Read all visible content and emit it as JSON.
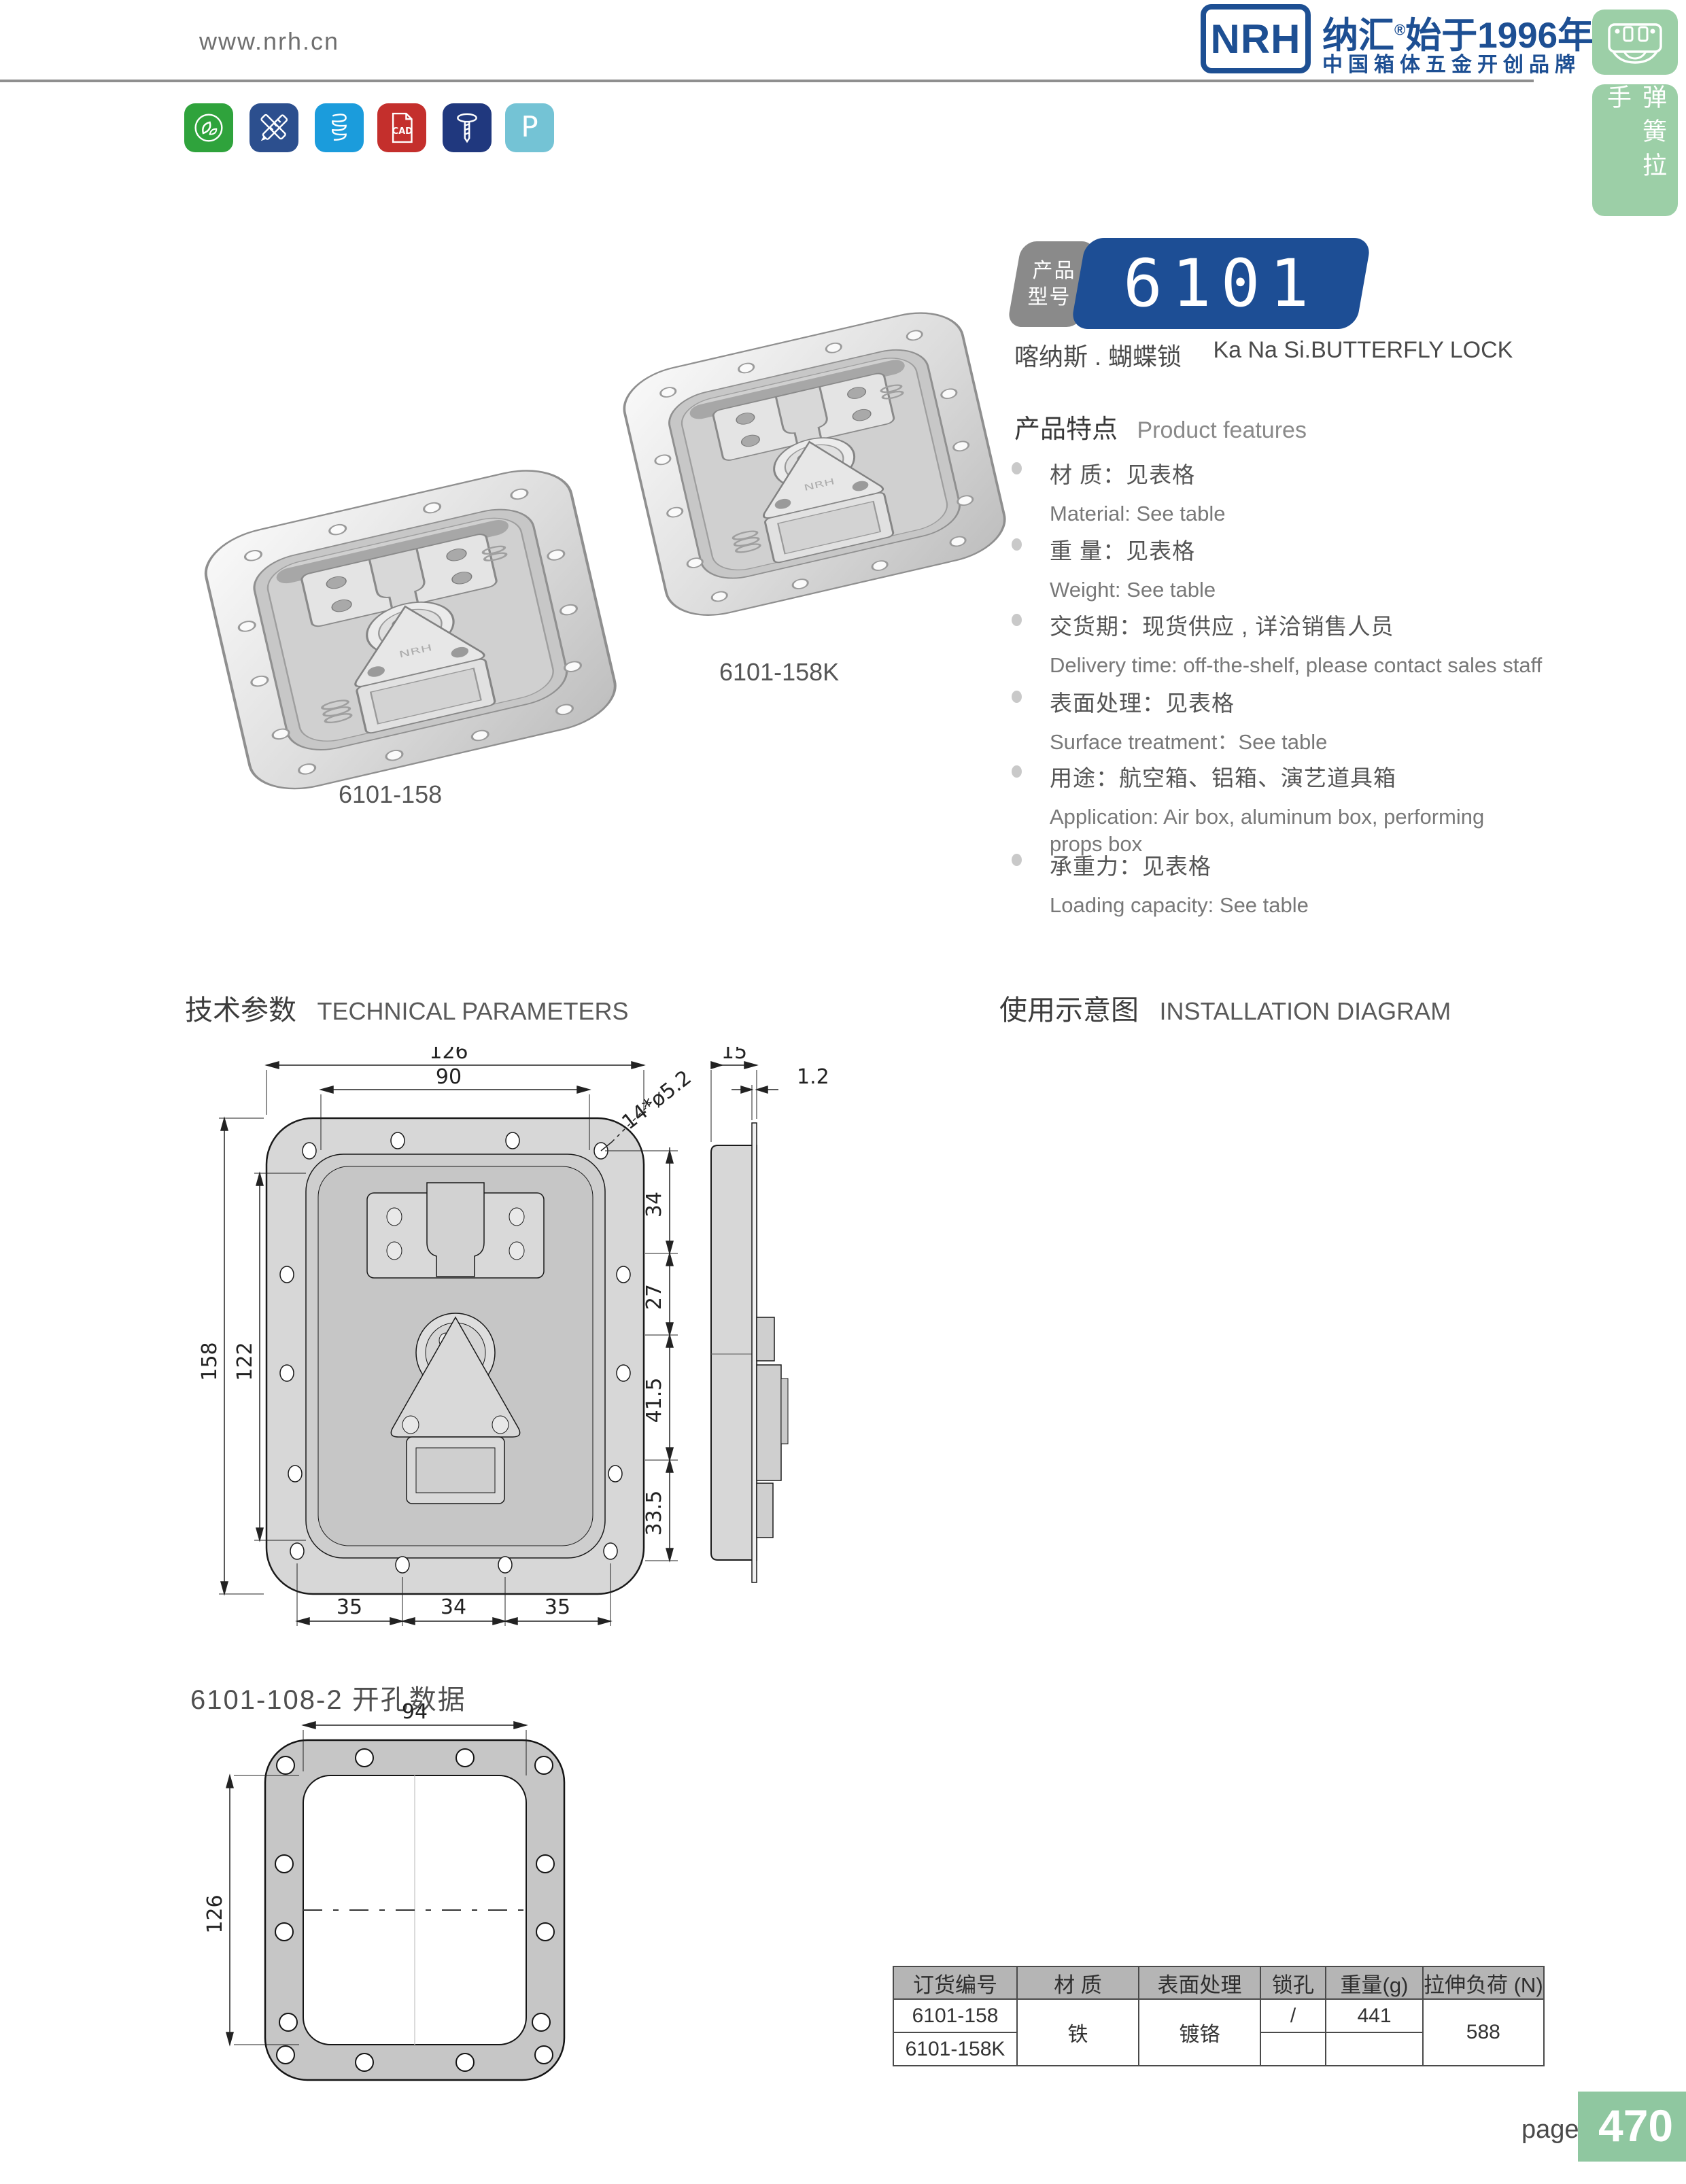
{
  "page": {
    "label": "page",
    "number": "470"
  },
  "header": {
    "website": "www.nrh.cn",
    "logo_abbr": "NRH",
    "brand_title": "纳汇",
    "brand_reg": "®",
    "brand_title_rest": "始于1996年",
    "brand_subtitle": "中国箱体五金开创品牌"
  },
  "sidebar": {
    "category": "弹簧拉手"
  },
  "toolbar_icons": [
    {
      "name": "eco-leaf",
      "bg": "#2fa33c"
    },
    {
      "name": "design-tools",
      "bg": "#2c4f8e"
    },
    {
      "name": "spring-coil",
      "bg": "#1b9cdc"
    },
    {
      "name": "cad-file",
      "bg": "#c42f2c",
      "label": "CAD"
    },
    {
      "name": "screw",
      "bg": "#20387e"
    },
    {
      "name": "letter-p",
      "bg": "#74c3d5",
      "label": "P"
    }
  ],
  "product": {
    "badge_top": "产品",
    "badge_bottom": "型号",
    "model": "6101",
    "name_cn": "喀纳斯 . 蝴蝶锁",
    "name_en": "Ka Na Si.BUTTERFLY LOCK",
    "photos": [
      {
        "label": "6101-158"
      },
      {
        "label": "6101-158K"
      }
    ]
  },
  "features": {
    "title_cn": "产品特点",
    "title_en": "Product features",
    "items": [
      {
        "cn": "材  质：见表格",
        "en": "Material: See table"
      },
      {
        "cn": "重  量：见表格",
        "en": "Weight: See table"
      },
      {
        "cn": "交货期：现货供应 , 详洽销售人员",
        "en": "Delivery time: off-the-shelf, please contact sales staff"
      },
      {
        "cn": "表面处理：见表格",
        "en": "Surface treatment：See table"
      },
      {
        "cn": "用途：航空箱、铝箱、演艺道具箱",
        "en": "Application: Air box, aluminum box, performing props box"
      },
      {
        "cn": "承重力：见表格",
        "en": "Loading capacity: See table"
      }
    ]
  },
  "sections": {
    "tech_cn": "技术参数",
    "tech_en": "TECHNICAL PARAMETERS",
    "install_cn": "使用示意图",
    "install_en": "INSTALLATION DIAGRAM"
  },
  "drawing_front": {
    "dim_width_outer": "126",
    "dim_width_inner": "90",
    "dim_holes": "14*ø5.2",
    "dim_height_outer": "158",
    "dim_height_inner": "122",
    "dim_r1": "34",
    "dim_r2": "27",
    "dim_r3": "41.5",
    "dim_r4": "33.5",
    "dim_b1": "35",
    "dim_b2": "34",
    "dim_b3": "35",
    "dim_side_width": "15",
    "dim_side_thickness": "1.2",
    "caption": "6101-108-2 开孔数据"
  },
  "drawing_cutout": {
    "dim_width": "94",
    "dim_height": "126"
  },
  "spec_table": {
    "headers": [
      "订货编号",
      "材  质",
      "表面处理",
      "锁孔",
      "重量(g)",
      "拉伸负荷 (N)"
    ],
    "rows": [
      {
        "code": "6101-158",
        "material": "铁",
        "surface": "镀铬",
        "lock_hole": "/",
        "weight": "441",
        "tensile_load": "588"
      },
      {
        "code": "6101-158K"
      }
    ]
  }
}
